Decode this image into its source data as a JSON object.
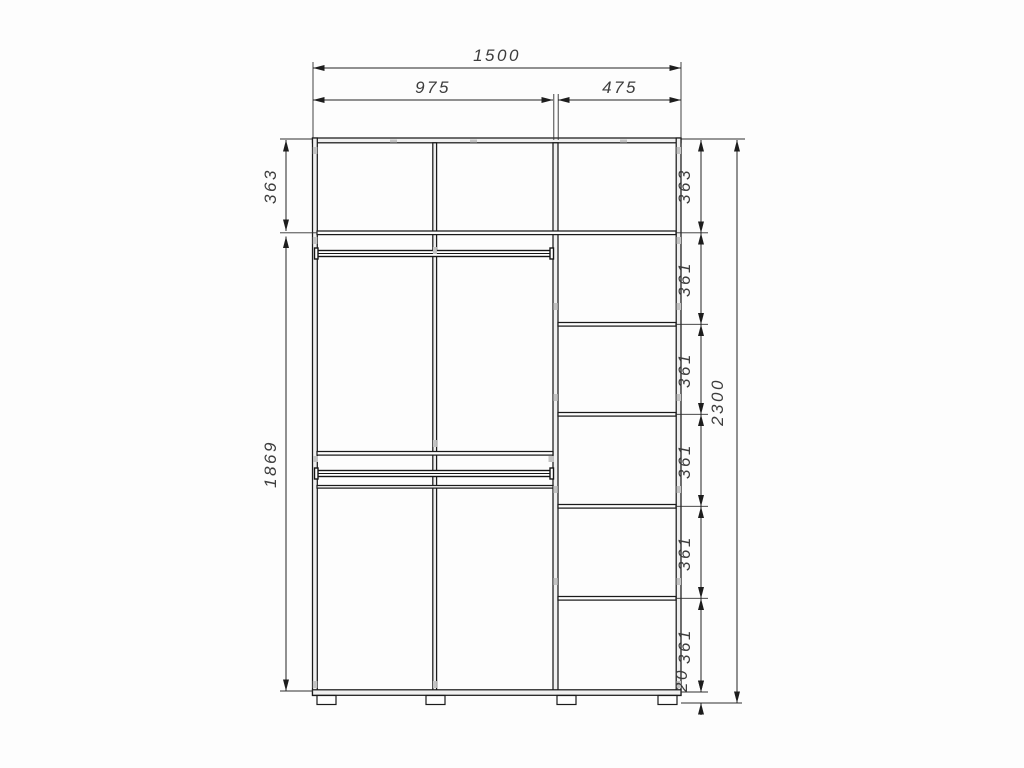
{
  "drawing": {
    "type": "wardrobe-interior-dimension-drawing",
    "units": "mm",
    "dims": {
      "total_width": "1500",
      "left_width": "975",
      "right_width": "475",
      "total_height": "2300",
      "left_top": "363",
      "left_body": "1869",
      "right_top": "363",
      "right_cells": [
        "361",
        "361",
        "361",
        "361",
        "361"
      ],
      "base_gap": "20"
    }
  }
}
